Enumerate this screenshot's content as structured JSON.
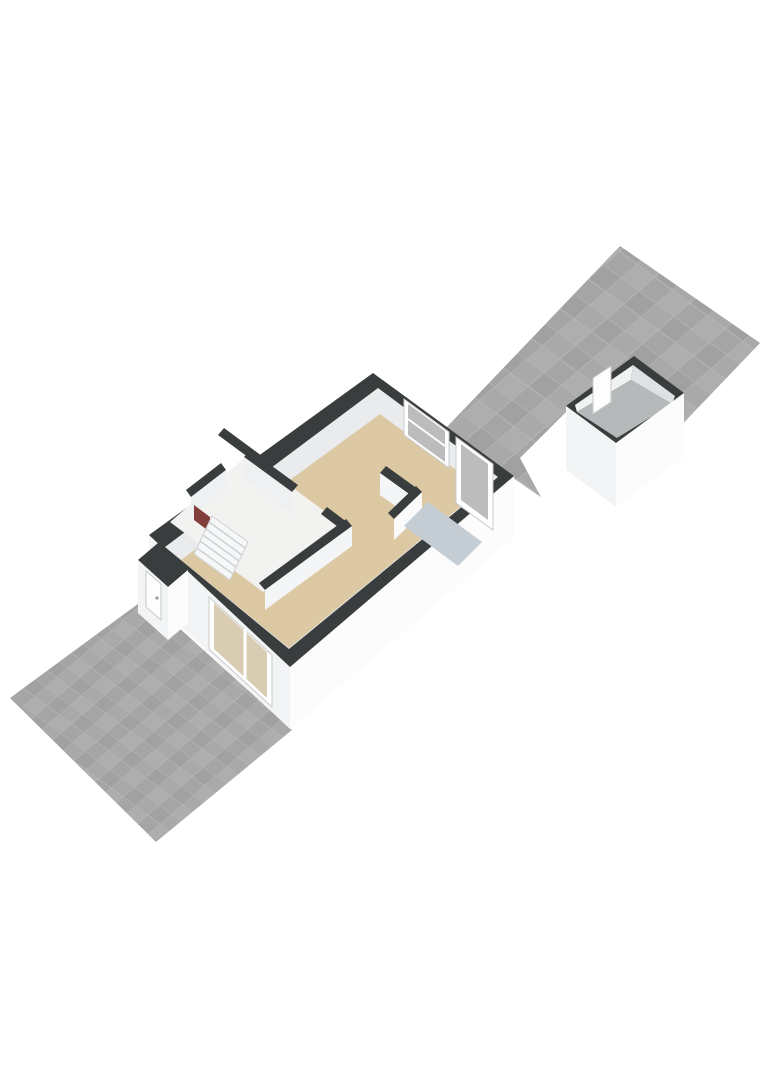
{
  "canvas": {
    "width": 768,
    "height": 1086,
    "background": "#ffffff"
  },
  "palette": {
    "background": "#ffffff",
    "wall_top": "#3a3d3e",
    "wall_ext_bright": "#fcfcfd",
    "wall_ext_shade": "#f3f4f5",
    "wall_int": "#e9ebec",
    "floor_living_beige": "#dcc9a3",
    "floor_pantry_blue": "#c4cdd3",
    "floor_shed_gray": "#b6b9ba",
    "floor_hall": "#f2f2f1",
    "tile_grout": "#b2b3b2",
    "tile_shades": [
      "#a4a5a4",
      "#adaead",
      "#a0a1a0",
      "#a8a9a8"
    ],
    "glass_gray": "#bbbcbb",
    "glass_beige": "#d8cdb3",
    "door_white": "#fdfdfd",
    "frame_gray": "#c9cbcc",
    "radiator_red": "#813e3a",
    "stair_tread": "#f6f7f8",
    "stair_line": "#ced1d2",
    "shed_int_left": "#f1f2f2",
    "shed_int_right": "#dfe2e3",
    "int_face_light": "#eef0f1",
    "int_face_lighter": "#f4f5f6",
    "int_face_white": "#fbfbfb"
  },
  "scene": {
    "description_names": [
      "rear-terrace",
      "garden-shed",
      "main-house",
      "front-yard"
    ],
    "elements": [
      {
        "name": "rear-terrace-tiles",
        "type": "polygon",
        "fill": "pattern:tilesA",
        "points": [
          [
            620,
            246
          ],
          [
            760,
            343
          ],
          [
            584,
            527
          ],
          [
            444,
            430
          ]
        ]
      },
      {
        "name": "ground-white-patch",
        "type": "polygon",
        "fill": "#ffffff",
        "points": [
          [
            520,
            458
          ],
          [
            567,
            411
          ],
          [
            645,
            480
          ],
          [
            580,
            570
          ]
        ]
      },
      {
        "name": "shed-wall-top-band",
        "type": "polygon",
        "fill": "@wall_top",
        "points": [
          [
            634,
            356
          ],
          [
            684,
            393
          ],
          [
            616,
            443
          ],
          [
            566,
            406
          ]
        ]
      },
      {
        "name": "shed-interior-wall-left",
        "type": "polygon",
        "fill": "@shed_int_left",
        "points": [
          [
            575,
            405
          ],
          [
            633,
            365
          ],
          [
            631,
            380
          ],
          [
            577,
            412
          ]
        ]
      },
      {
        "name": "shed-interior-wall-right",
        "type": "polygon",
        "fill": "@shed_int_right",
        "points": [
          [
            633,
            365
          ],
          [
            675,
            396
          ],
          [
            672,
            404
          ],
          [
            631,
            380
          ]
        ]
      },
      {
        "name": "shed-floor",
        "type": "polygon",
        "fill": "@floor_shed_gray",
        "points": [
          [
            577,
            412
          ],
          [
            631,
            380
          ],
          [
            672,
            404
          ],
          [
            617,
            438
          ]
        ]
      },
      {
        "name": "shed-door",
        "type": "polygon",
        "fill": "@door_white",
        "stroke": "@frame_gray",
        "strokeWidth": 1,
        "points": [
          [
            593,
            378
          ],
          [
            611,
            366
          ],
          [
            611,
            402
          ],
          [
            593,
            414
          ]
        ]
      },
      {
        "name": "shed-exterior-wall-left",
        "type": "polygon",
        "fill": "@wall_ext_shade",
        "points": [
          [
            566,
            406
          ],
          [
            616,
            443
          ],
          [
            616,
            507
          ],
          [
            566,
            470
          ]
        ]
      },
      {
        "name": "shed-exterior-wall-right",
        "type": "polygon",
        "fill": "@wall_ext_bright",
        "points": [
          [
            616,
            443
          ],
          [
            684,
            393
          ],
          [
            684,
            457
          ],
          [
            616,
            507
          ]
        ]
      },
      {
        "name": "front-yard-tiles",
        "type": "polygon",
        "fill": "pattern:tilesB",
        "points": [
          [
            146,
            598
          ],
          [
            292,
            730
          ],
          [
            156,
            842
          ],
          [
            10,
            698
          ]
        ]
      },
      {
        "name": "house-exterior-wall-right",
        "type": "polygon",
        "fill": "@wall_ext_bright",
        "points": [
          [
            514,
            476
          ],
          [
            290,
            667
          ],
          [
            290,
            729
          ],
          [
            514,
            538
          ]
        ]
      },
      {
        "name": "house-exterior-wall-front",
        "type": "polygon",
        "fill": "@wall_ext_shade",
        "points": [
          [
            149,
            535
          ],
          [
            290,
            667
          ],
          [
            290,
            729
          ],
          [
            149,
            597
          ]
        ]
      },
      {
        "name": "front-window-frame",
        "type": "polygon",
        "fill": "#ffffff",
        "stroke": "@frame_gray",
        "strokeWidth": 1,
        "points": [
          [
            209,
            597
          ],
          [
            272,
            655
          ],
          [
            272,
            707
          ],
          [
            209,
            649
          ]
        ]
      },
      {
        "name": "front-window-glass",
        "type": "polygon",
        "fill": "@glass_beige",
        "points": [
          [
            214,
            603
          ],
          [
            267,
            652
          ],
          [
            267,
            698
          ],
          [
            214,
            649
          ]
        ]
      },
      {
        "name": "front-window-mullion",
        "type": "lines",
        "stroke": "#ffffff",
        "strokeWidth": 3,
        "segments": [
          [
            [
              245,
              629
            ],
            [
              245,
              679
            ]
          ]
        ]
      },
      {
        "name": "house-wall-top-band",
        "type": "polygon",
        "fill": "@wall_top",
        "points": [
          [
            373,
            373
          ],
          [
            514,
            476
          ],
          [
            290,
            667
          ],
          [
            149,
            535
          ]
        ]
      },
      {
        "name": "house-interior-wall-faces",
        "type": "polygon",
        "fill": "@wall_int",
        "points": [
          [
            378,
            388
          ],
          [
            498,
            477
          ],
          [
            289,
            649
          ],
          [
            165,
            547
          ]
        ]
      },
      {
        "name": "living-room-floor",
        "type": "polygon",
        "fill": "@floor_living_beige",
        "points": [
          [
            380,
            414
          ],
          [
            482,
            489
          ],
          [
            289,
            648
          ],
          [
            181,
            560
          ]
        ]
      },
      {
        "name": "hall-floor",
        "type": "polygon",
        "fill": "@floor_hall",
        "points": [
          [
            248,
            455
          ],
          [
            350,
            530
          ],
          [
            263,
            592
          ],
          [
            170,
            522
          ]
        ]
      },
      {
        "name": "hall-wall-band-a",
        "type": "polygon",
        "fill": "@wall_top",
        "points": [
          [
            250,
            450
          ],
          [
            298,
            485
          ],
          [
            292,
            492
          ],
          [
            244,
            457
          ]
        ]
      },
      {
        "name": "hall-wall-face-a",
        "type": "polygon",
        "fill": "@int_face_light",
        "points": [
          [
            244,
            457
          ],
          [
            292,
            492
          ],
          [
            292,
            514
          ],
          [
            244,
            479
          ]
        ]
      },
      {
        "name": "hall-wall-band-corner",
        "type": "polygon",
        "fill": "@wall_top",
        "points": [
          [
            327,
            507
          ],
          [
            352,
            526
          ],
          [
            346,
            533
          ],
          [
            321,
            514
          ]
        ]
      },
      {
        "name": "hall-wall-band-b",
        "type": "polygon",
        "fill": "@wall_top",
        "points": [
          [
            346,
            519
          ],
          [
            352,
            526
          ],
          [
            265,
            590
          ],
          [
            259,
            583
          ]
        ]
      },
      {
        "name": "hall-wall-face-b",
        "type": "polygon",
        "fill": "@int_face_lighter",
        "points": [
          [
            352,
            526
          ],
          [
            265,
            590
          ],
          [
            265,
            610
          ],
          [
            352,
            546
          ]
        ]
      },
      {
        "name": "closet-wall-band-a",
        "type": "polygon",
        "fill": "@wall_top",
        "points": [
          [
            224,
            428
          ],
          [
            262,
            456
          ],
          [
            256,
            463
          ],
          [
            218,
            435
          ]
        ]
      },
      {
        "name": "closet-wall-band-b",
        "type": "polygon",
        "fill": "@wall_top",
        "points": [
          [
            186,
            490
          ],
          [
            221,
            463
          ],
          [
            226,
            470
          ],
          [
            191,
            497
          ]
        ]
      },
      {
        "name": "closet-wall-face-b",
        "type": "polygon",
        "fill": "@int_face_light",
        "points": [
          [
            191,
            497
          ],
          [
            226,
            470
          ],
          [
            226,
            490
          ],
          [
            191,
            517
          ]
        ]
      },
      {
        "name": "closet-radiator",
        "type": "polygon",
        "fill": "@radiator_red",
        "points": [
          [
            194,
            505
          ],
          [
            210,
            517
          ],
          [
            210,
            532
          ],
          [
            194,
            520
          ]
        ]
      },
      {
        "name": "staircase-base",
        "type": "polygon",
        "fill": "@stair_tread",
        "stroke": "@stair_line",
        "strokeWidth": 1,
        "points": [
          [
            212,
            516
          ],
          [
            248,
            542
          ],
          [
            230,
            580
          ],
          [
            194,
            554
          ]
        ]
      },
      {
        "name": "staircase-treads",
        "type": "lines",
        "stroke": "@stair_line",
        "strokeWidth": 1.5,
        "segments": [
          [
            [
              209,
              522
            ],
            [
              245,
              548
            ]
          ],
          [
            [
              206,
              529
            ],
            [
              242,
              555
            ]
          ],
          [
            [
              203,
              535
            ],
            [
              239,
              561
            ]
          ],
          [
            [
              200,
              541
            ],
            [
              236,
              567
            ]
          ],
          [
            [
              197,
              548
            ],
            [
              233,
              574
            ]
          ]
        ]
      },
      {
        "name": "back-window-frame",
        "type": "polygon",
        "fill": "#ffffff",
        "stroke": "@frame_gray",
        "strokeWidth": 1,
        "points": [
          [
            404,
            399
          ],
          [
            449,
            432
          ],
          [
            449,
            468
          ],
          [
            404,
            435
          ]
        ]
      },
      {
        "name": "back-window-glass",
        "type": "polygon",
        "fill": "@glass_gray",
        "points": [
          [
            408,
            404
          ],
          [
            445,
            431
          ],
          [
            445,
            462
          ],
          [
            408,
            435
          ]
        ]
      },
      {
        "name": "back-window-mullion",
        "type": "lines",
        "stroke": "#ffffff",
        "strokeWidth": 2,
        "segments": [
          [
            [
              408,
              419
            ],
            [
              445,
              446
            ]
          ]
        ]
      },
      {
        "name": "back-door-frame",
        "type": "polygon",
        "fill": "#ffffff",
        "stroke": "@frame_gray",
        "strokeWidth": 1,
        "points": [
          [
            456,
            437
          ],
          [
            493,
            464
          ],
          [
            493,
            530
          ],
          [
            456,
            503
          ]
        ]
      },
      {
        "name": "back-door-glass",
        "type": "polygon",
        "fill": "@glass_gray",
        "points": [
          [
            461,
            444
          ],
          [
            488,
            464
          ],
          [
            488,
            520
          ],
          [
            461,
            500
          ]
        ]
      },
      {
        "name": "pantry-wall-band-a",
        "type": "polygon",
        "fill": "@wall_top",
        "points": [
          [
            386,
            466
          ],
          [
            422,
            492
          ],
          [
            416,
            499
          ],
          [
            380,
            473
          ]
        ]
      },
      {
        "name": "pantry-wall-face-a",
        "type": "polygon",
        "fill": "@int_face_lighter",
        "points": [
          [
            380,
            473
          ],
          [
            416,
            499
          ],
          [
            416,
            521
          ],
          [
            380,
            495
          ]
        ]
      },
      {
        "name": "pantry-wall-band-b",
        "type": "polygon",
        "fill": "@wall_top",
        "points": [
          [
            416,
            486
          ],
          [
            422,
            492
          ],
          [
            394,
            519
          ],
          [
            388,
            513
          ]
        ]
      },
      {
        "name": "pantry-wall-face-b",
        "type": "polygon",
        "fill": "@int_face_white",
        "points": [
          [
            422,
            492
          ],
          [
            394,
            519
          ],
          [
            394,
            540
          ],
          [
            422,
            513
          ]
        ]
      },
      {
        "name": "pantry-floor",
        "type": "polygon",
        "fill": "@floor_pantry_blue",
        "points": [
          [
            428,
            502
          ],
          [
            482,
            542
          ],
          [
            458,
            566
          ],
          [
            404,
            526
          ]
        ]
      },
      {
        "name": "porch-wall-top-band",
        "type": "polygon",
        "fill": "@wall_top",
        "points": [
          [
            158,
            543
          ],
          [
            188,
            570
          ],
          [
            168,
            587
          ],
          [
            138,
            560
          ]
        ]
      },
      {
        "name": "porch-exterior-wall-left",
        "type": "polygon",
        "fill": "@wall_ext_shade",
        "points": [
          [
            138,
            560
          ],
          [
            168,
            587
          ],
          [
            168,
            640
          ],
          [
            138,
            613
          ]
        ]
      },
      {
        "name": "porch-exterior-wall-right",
        "type": "polygon",
        "fill": "@wall_ext_bright",
        "points": [
          [
            168,
            587
          ],
          [
            188,
            570
          ],
          [
            188,
            623
          ],
          [
            168,
            640
          ]
        ]
      },
      {
        "name": "front-door",
        "type": "polygon",
        "fill": "@door_white",
        "stroke": "@frame_gray",
        "strokeWidth": 1,
        "points": [
          [
            146,
            571
          ],
          [
            161,
            584
          ],
          [
            161,
            620
          ],
          [
            146,
            607
          ]
        ]
      },
      {
        "name": "front-door-handle",
        "type": "circle",
        "fill": "#9b9ea0",
        "cx": 157,
        "cy": 598,
        "r": 1.6
      }
    ]
  }
}
